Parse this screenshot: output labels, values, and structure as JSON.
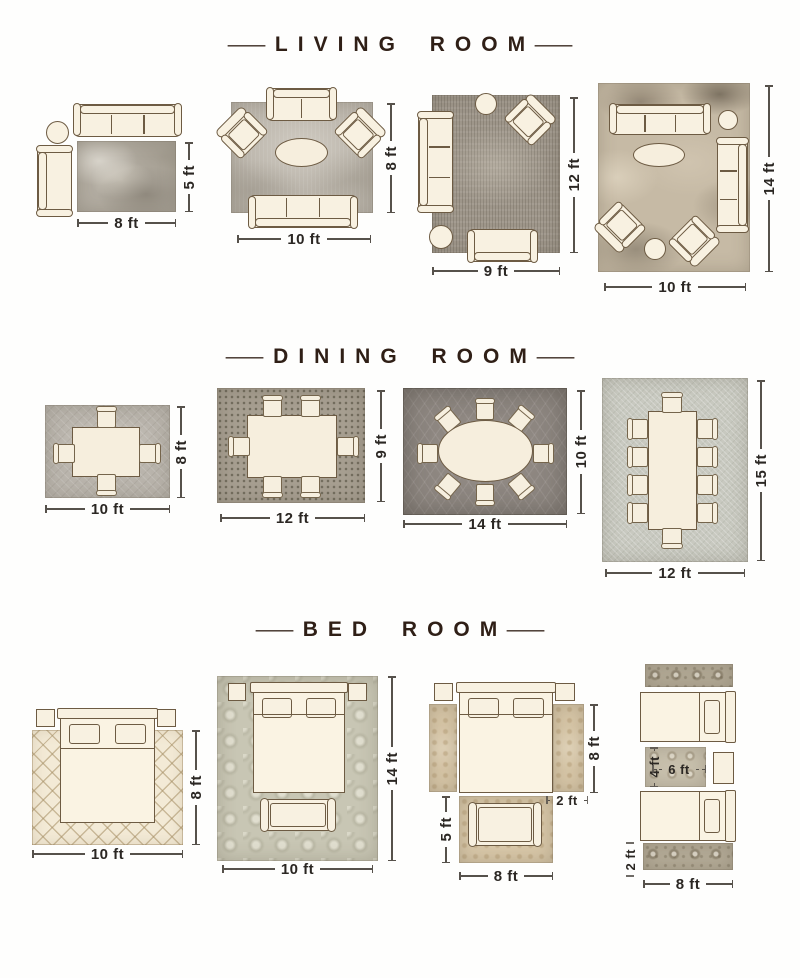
{
  "decor": {
    "dash": "—"
  },
  "sections": {
    "living": {
      "title": "LIVING ROOM",
      "layouts": [
        {
          "width_label": "8 ft",
          "height_label": "5 ft"
        },
        {
          "width_label": "10 ft",
          "height_label": "8 ft"
        },
        {
          "width_label": "9 ft",
          "height_label": "12 ft"
        },
        {
          "width_label": "10 ft",
          "height_label": "14 ft"
        }
      ]
    },
    "dining": {
      "title": "DINING ROOM",
      "layouts": [
        {
          "width_label": "10 ft",
          "height_label": "8 ft"
        },
        {
          "width_label": "12 ft",
          "height_label": "9 ft"
        },
        {
          "width_label": "14 ft",
          "height_label": "10 ft"
        },
        {
          "width_label": "12 ft",
          "height_label": "15 ft"
        }
      ]
    },
    "bed": {
      "title": "BED ROOM",
      "layouts": [
        {
          "width_label": "10 ft",
          "height_label": "8 ft"
        },
        {
          "width_label": "10 ft",
          "height_label": "14 ft"
        },
        {
          "bed_side_label": "8 ft",
          "runner_width_label": "2 ft",
          "foot_rug_height_label": "5 ft",
          "foot_rug_width_label": "8 ft"
        },
        {
          "small_rug_height_label": "4 ft",
          "small_rug_width_label": "6 ft",
          "runner_width_label": "2 ft",
          "runner_length_label": "8 ft"
        }
      ]
    }
  }
}
